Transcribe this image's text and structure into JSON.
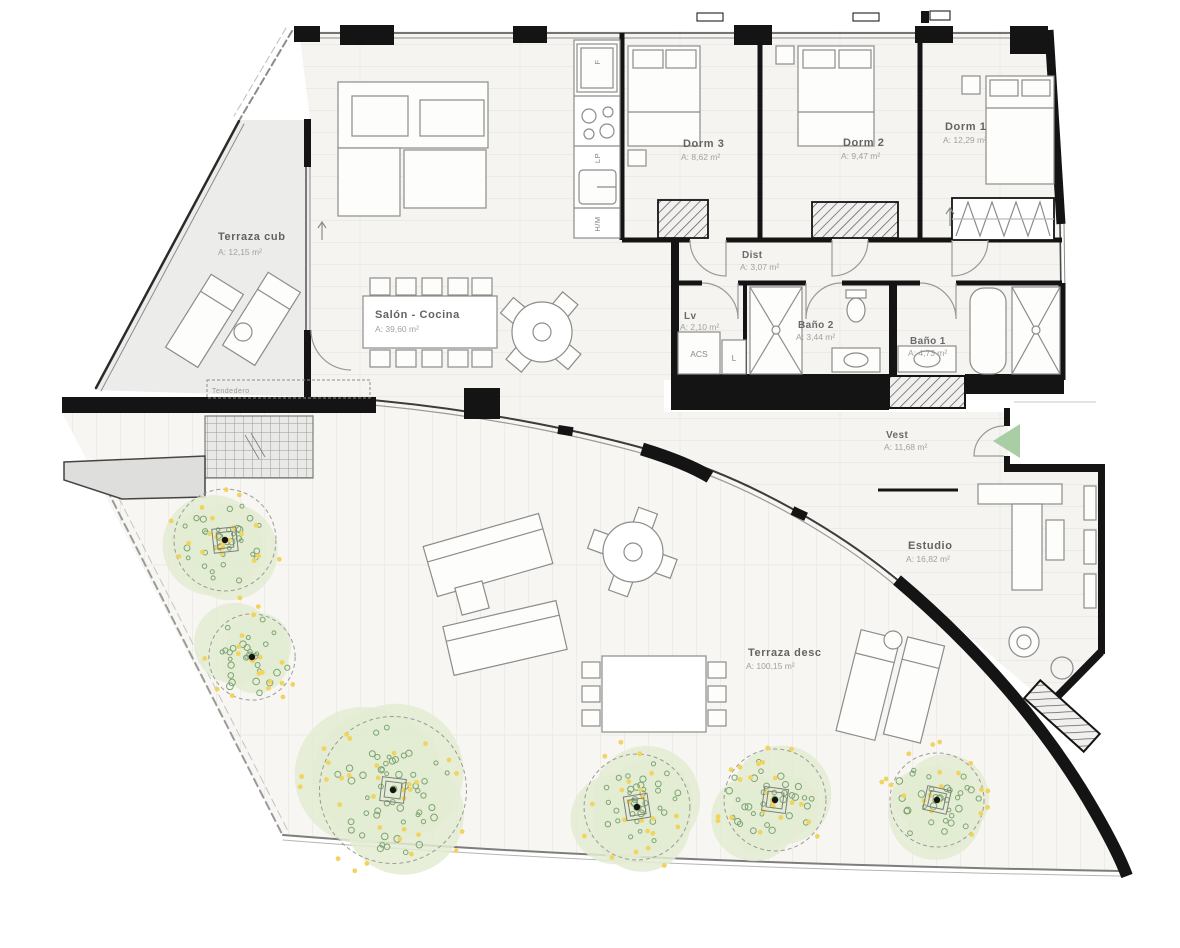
{
  "plan": {
    "type": "apartment-floor-plan",
    "rooms": {
      "terraza_cub": {
        "name": "Terraza cub",
        "area": "A: 12,15 m²"
      },
      "salon": {
        "name": "Salón - Cocina",
        "area": "A: 39,60 m²"
      },
      "dorm3": {
        "name": "Dorm 3",
        "area": "A: 8,62 m²"
      },
      "dorm2": {
        "name": "Dorm 2",
        "area": "A: 9,47 m²"
      },
      "dorm1": {
        "name": "Dorm 1",
        "area": "A: 12,29 m²"
      },
      "dist": {
        "name": "Dist",
        "area": "A: 3,07 m²"
      },
      "lv": {
        "name": "Lv",
        "area": "A: 2,10 m²"
      },
      "bano2": {
        "name": "Baño 2",
        "area": "A: 3,44 m²"
      },
      "bano1": {
        "name": "Baño 1",
        "area": "A: 4,73 m²"
      },
      "vest": {
        "name": "Vest",
        "area": "A: 11,68 m²"
      },
      "estudio": {
        "name": "Estudio",
        "area": "A: 16,82 m²"
      },
      "terraza_desc": {
        "name": "Terraza desc",
        "area": "A: 100,15 m²"
      }
    },
    "labels": {
      "fridge": "F",
      "dishwasher": "LP",
      "oven_micro": "H/M",
      "water_heater": "ACS",
      "laundry": "L",
      "drying_area": "Tendedero"
    },
    "colors": {
      "wall": "#141414",
      "line": "#8c8c8a",
      "floor_line": "#e2dfda",
      "interior_fill": "#f5f4f1",
      "terrace_fill": "#f7f6f3",
      "cover_terrace_fill": "#ececea",
      "canopy": "#e3ecd2",
      "leaf_ring": "#7da371",
      "flower_dot": "#f1d35f",
      "entry_arrow": "#a9cea6",
      "planter_gray": "#dededc"
    }
  }
}
